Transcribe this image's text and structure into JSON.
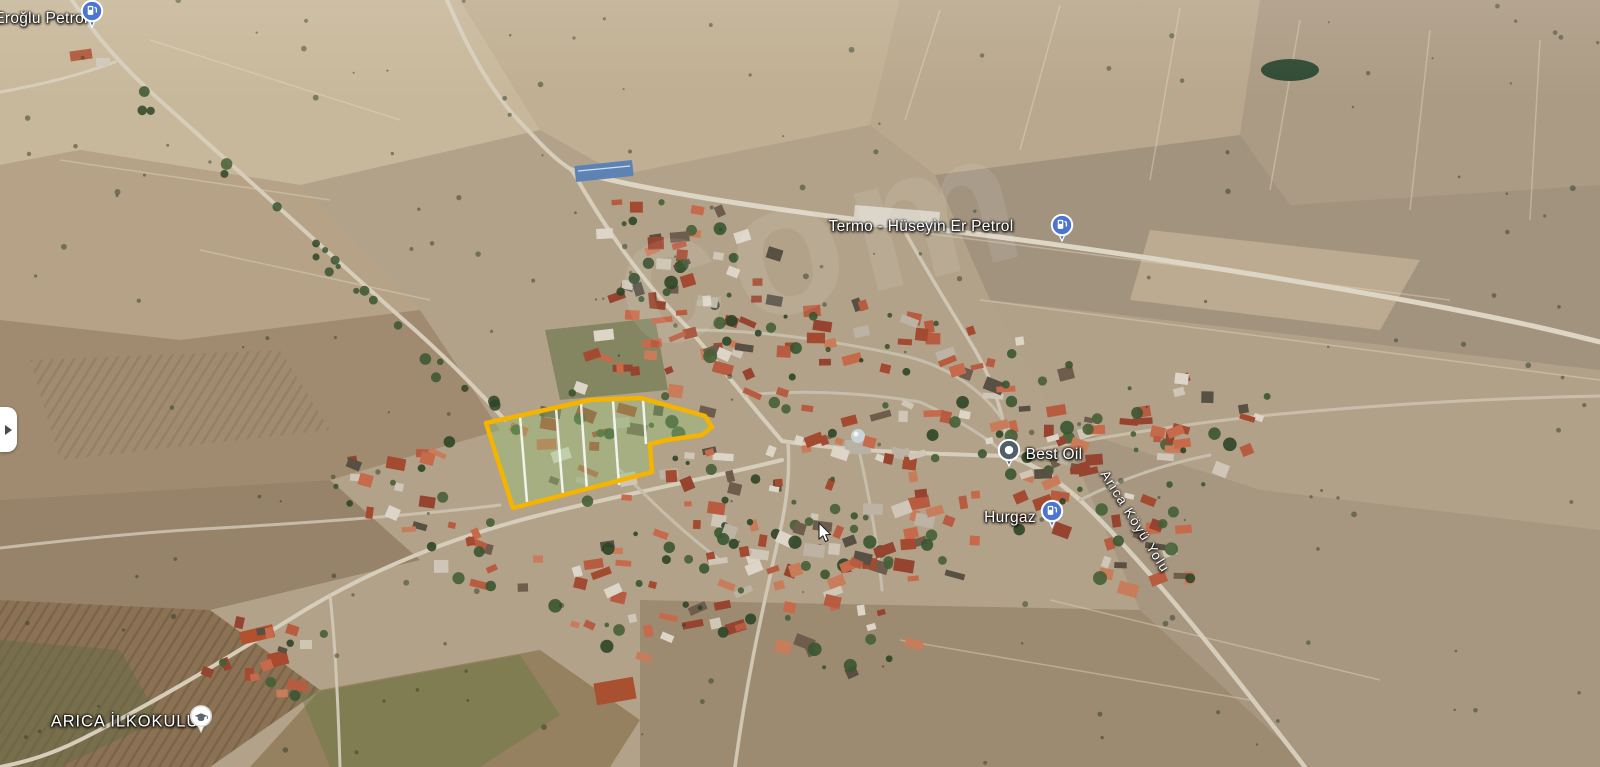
{
  "map": {
    "view_type": "3d-satellite-aerial",
    "place_labels": [
      {
        "id": "eroglu",
        "text": "Eroğlu Petrol",
        "pin": "gas-station",
        "pin_color": "#4A75D4",
        "label_x": 41,
        "label_y": 19,
        "pin_x": 92,
        "pin_y": 17
      },
      {
        "id": "termo",
        "text": "Termo - Hüseyin Er Petrol",
        "pin": "gas-station",
        "pin_color": "#4A75D4",
        "label_x": 921,
        "label_y": 227,
        "pin_x": 1062,
        "pin_y": 231
      },
      {
        "id": "bestoil",
        "text": "Best Oil",
        "pin": "business",
        "pin_color": "#525E68",
        "label_x": 1054,
        "label_y": 455,
        "pin_x": 1009,
        "pin_y": 456
      },
      {
        "id": "hurgaz",
        "text": "Hurgaz",
        "pin": "gas-station",
        "pin_color": "#4A75D4",
        "label_x": 1010,
        "label_y": 518,
        "pin_x": 1052,
        "pin_y": 517
      },
      {
        "id": "school",
        "text": "ARICA İLKOKULU",
        "pin": "school",
        "pin_color": "#FFFFFF",
        "label_x": 125,
        "label_y": 722,
        "pin_x": 201,
        "pin_y": 722
      }
    ],
    "road_label": {
      "text": "Arıca Köyü Yolu",
      "x": 1104,
      "y": 464,
      "rotation_deg": 58
    },
    "highlighted_parcel": {
      "outline_color": "#F4B400",
      "fill_color": "rgba(145,198,118,0.38)",
      "divider_color": "rgba(255,255,255,0.85)",
      "outline_points": "486,423 590,400 641,398 705,416 712,427 702,435 667,440 650,444 652,472 513,508",
      "divider_lines": [
        "520,416 527,502",
        "556,408 563,495",
        "581,404 587,491",
        "613,401 619,485",
        "643,399 646,444"
      ]
    },
    "watermark": {
      "text": "com",
      "opacity": 0.085
    },
    "controls": {
      "sidebar_toggle_icon": "right-arrow"
    },
    "cursor": {
      "x": 818,
      "y": 522
    }
  }
}
